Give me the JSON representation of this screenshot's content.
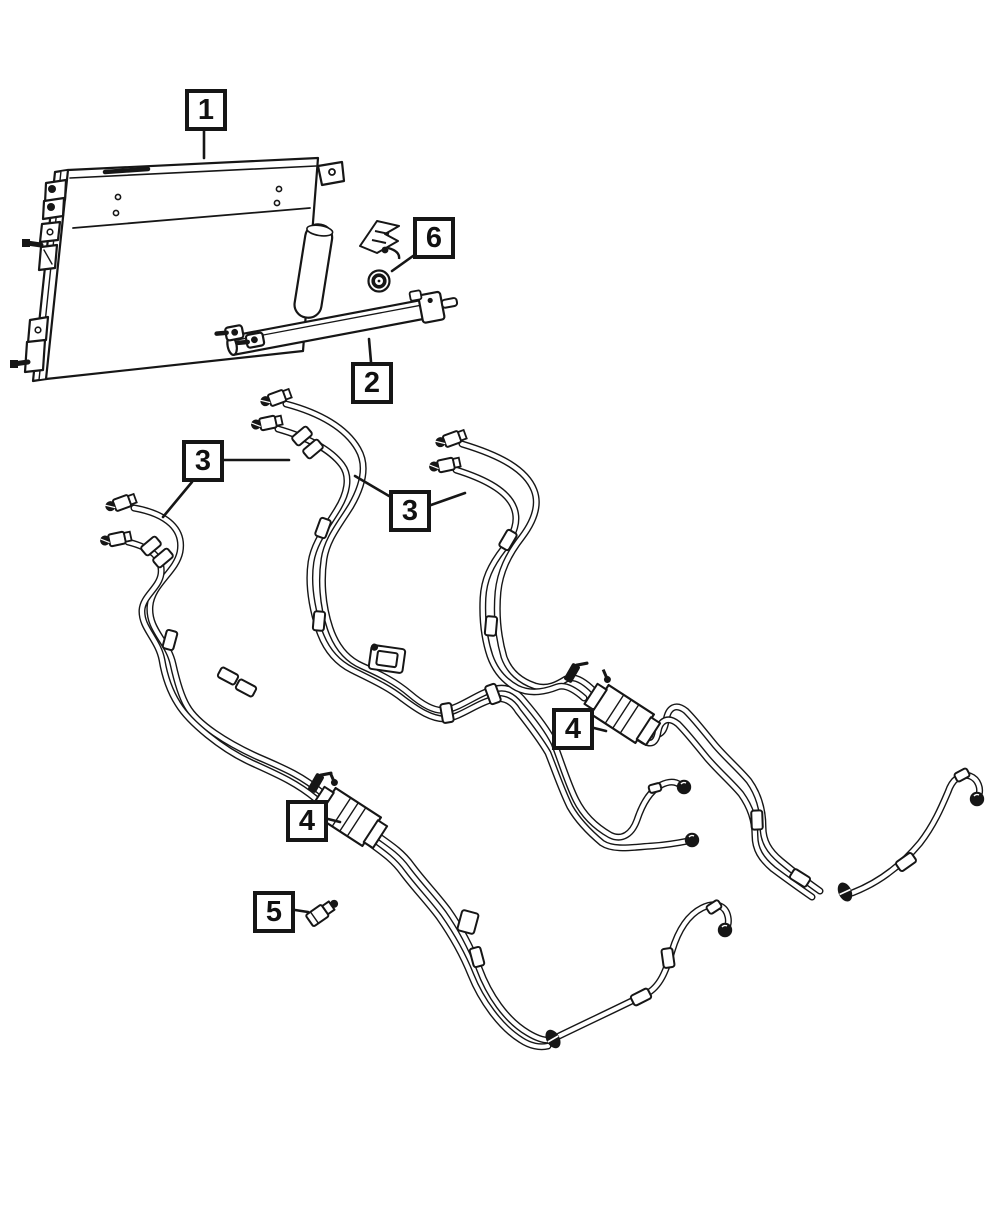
{
  "page": {
    "background": "#ffffff",
    "line_color": "#161616",
    "accent_color": "#000000"
  },
  "diagram": {
    "type": "parts-callout-diagram",
    "callouts": [
      {
        "id": "callout-1",
        "label": "1",
        "box": {
          "x": 185,
          "y": 89
        },
        "leaders": [
          [
            204,
            131,
            204,
            158
          ]
        ]
      },
      {
        "id": "callout-6",
        "label": "6",
        "box": {
          "x": 413,
          "y": 217
        },
        "leaders": [
          [
            413,
            256,
            392,
            271
          ]
        ]
      },
      {
        "id": "callout-2",
        "label": "2",
        "box": {
          "x": 351,
          "y": 362
        },
        "leaders": [
          [
            371,
            362,
            369,
            339
          ]
        ]
      },
      {
        "id": "callout-3a",
        "label": "3",
        "box": {
          "x": 182,
          "y": 440
        },
        "leaders": [
          [
            224,
            460,
            289,
            460
          ],
          [
            192,
            482,
            163,
            517
          ]
        ]
      },
      {
        "id": "callout-3b",
        "label": "3",
        "box": {
          "x": 389,
          "y": 490
        },
        "leaders": [
          [
            389,
            496,
            355,
            476
          ],
          [
            431,
            505,
            465,
            493
          ]
        ]
      },
      {
        "id": "callout-4a",
        "label": "4",
        "box": {
          "x": 552,
          "y": 708
        },
        "leaders": [
          [
            594,
            728,
            606,
            731
          ]
        ]
      },
      {
        "id": "callout-4b",
        "label": "4",
        "box": {
          "x": 286,
          "y": 800
        },
        "leaders": [
          [
            328,
            819,
            340,
            822
          ]
        ]
      },
      {
        "id": "callout-5",
        "label": "5",
        "box": {
          "x": 253,
          "y": 891
        },
        "leaders": [
          [
            295,
            910,
            308,
            912
          ]
        ]
      }
    ]
  }
}
